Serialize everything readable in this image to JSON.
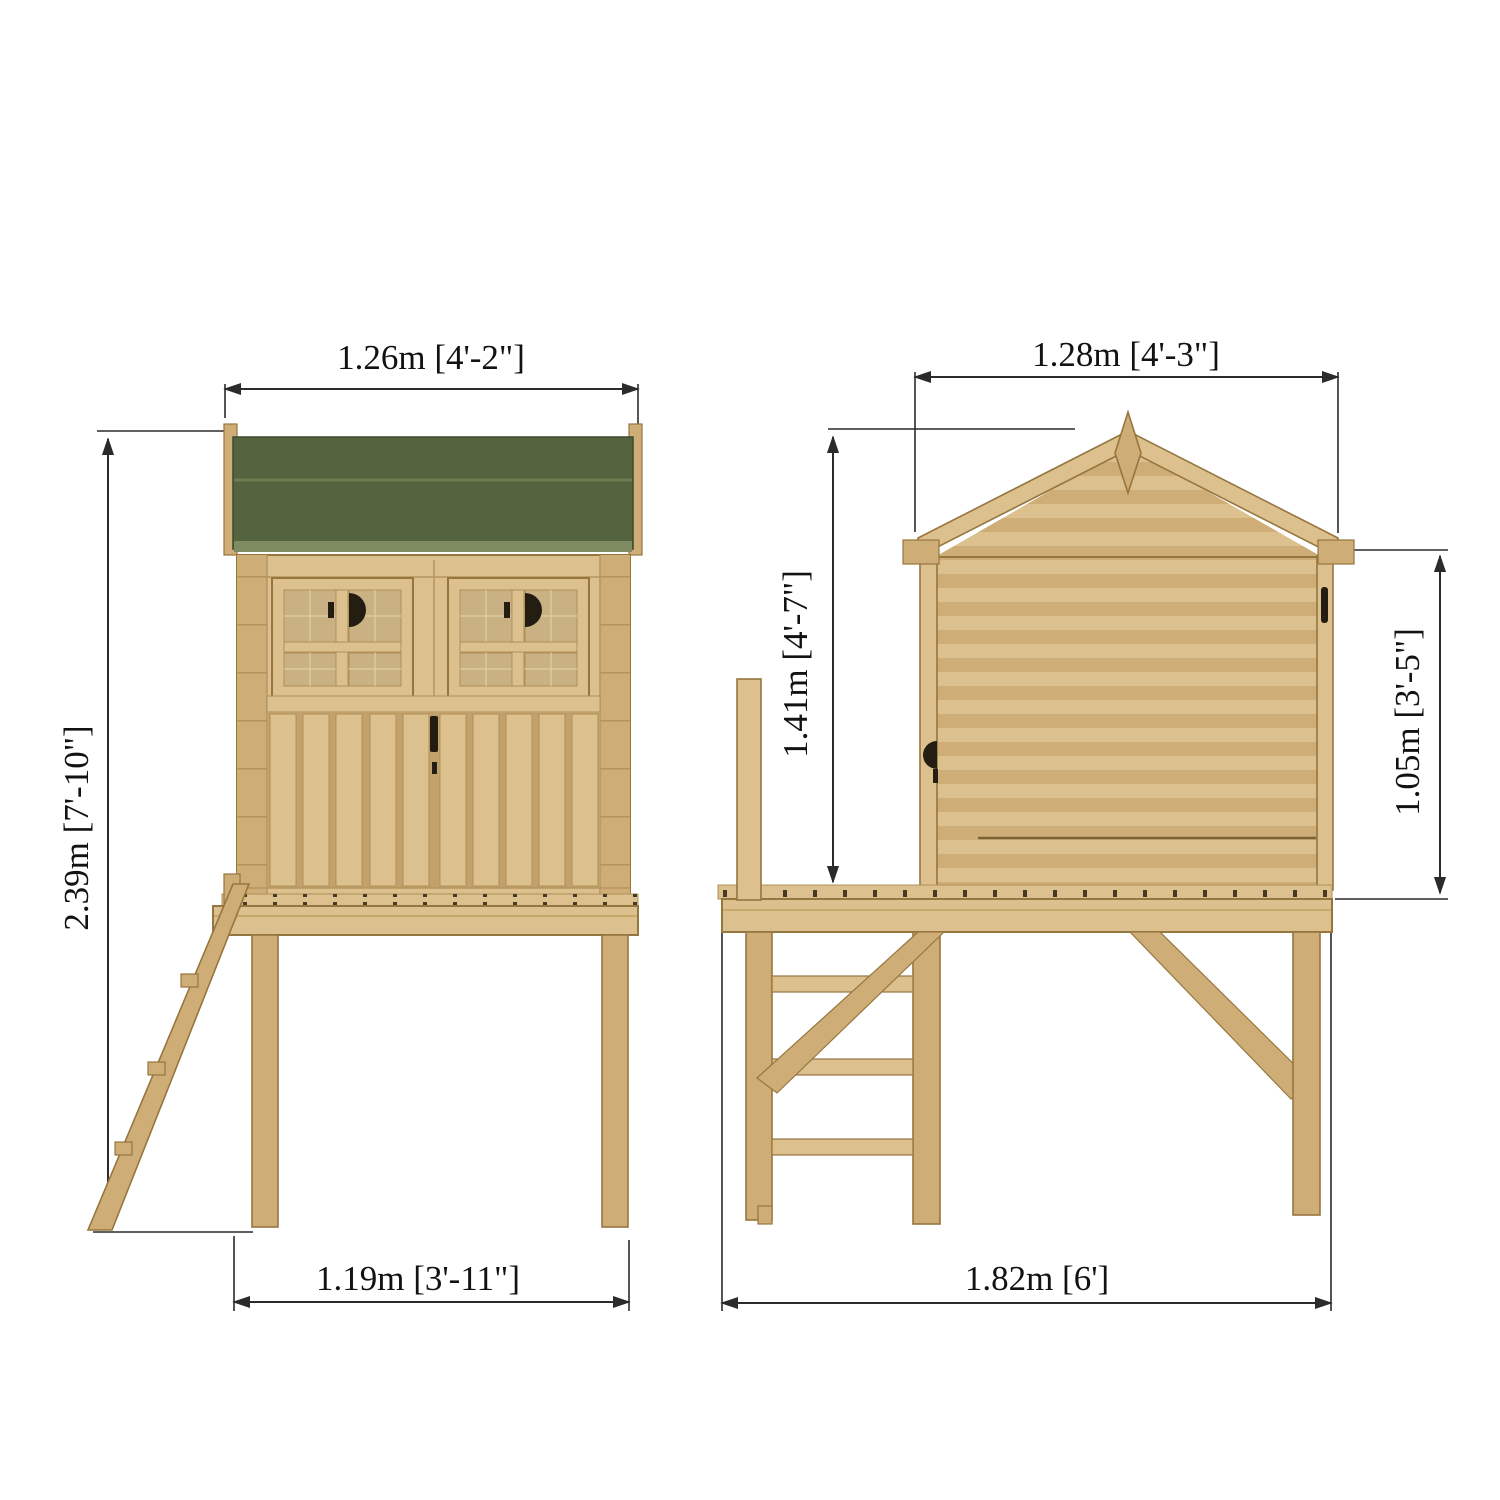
{
  "diagram": {
    "front_view": {
      "width_top_label": "1.26m [4'-2\"]",
      "height_left_label": "2.39m [7'-10\"]",
      "width_bottom_label": "1.19m [3'-11\"]"
    },
    "side_view": {
      "width_top_label": "1.28m [4'-3\"]",
      "apex_height_label": "1.41m [4'-7\"]",
      "wall_height_label": "1.05m [3'-5\"]",
      "width_bottom_label": "1.82m [6']"
    }
  },
  "colors": {
    "background": "#ffffff",
    "dimLine": "#2b2b2b",
    "textColor": "#121212",
    "roofGreen": "#53643f",
    "roofDivider": "#6e7e52",
    "roofFade": "#7f8c62",
    "roofEdge": "#3d4a2d",
    "woodLight": "#dcc08d",
    "woodMid": "#cfad76",
    "woodShadow": "#b5955e",
    "outline": "#96763f",
    "pane": "#c9b183",
    "glaze": "#e0cfa6",
    "slatGap": "#c2a26a",
    "beamLine": "#c8a76c",
    "darkDetail": "#241d12"
  }
}
